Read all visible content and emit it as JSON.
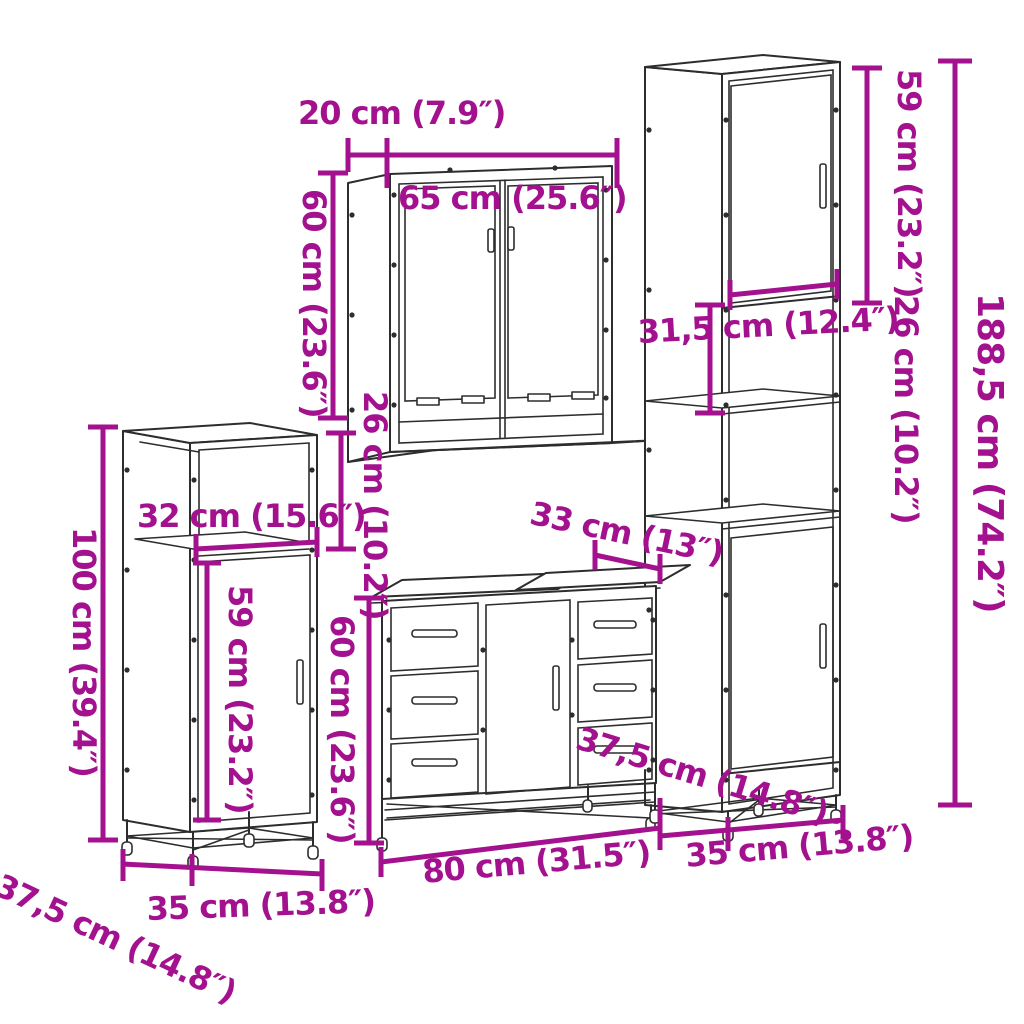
{
  "colors": {
    "dimension": "#A3118F",
    "line_art": "#2D2D2D",
    "background": "#FFFFFF"
  },
  "dimensions": {
    "mirror_cabinet": {
      "depth": "20 cm (7.9″)",
      "width": "65 cm (25.6″)",
      "height": "60 cm (23.6″)",
      "clearance_below": "26 cm (10.2″)"
    },
    "tall_cabinet": {
      "upper_door_height": "59 cm (23.2″)",
      "shelf_spacing": "26 cm (10.2″)",
      "total_height": "188,5 cm (74.2″)",
      "inner_width": "31,5 cm (12.4″)",
      "depth": "37,5 cm (14.8″)",
      "width": "35 cm (13.8″)"
    },
    "side_cabinet": {
      "height": "100 cm (39.4″)",
      "inner_width": "32 cm (15.6″)",
      "door_height": "59 cm (23.2″)",
      "width": "35 cm (13.8″)",
      "depth": "37,5 cm (14.8″)"
    },
    "vanity_cabinet": {
      "top_depth": "33 cm (13″)",
      "height": "60 cm (23.6″)",
      "width": "80 cm (31.5″)"
    }
  }
}
